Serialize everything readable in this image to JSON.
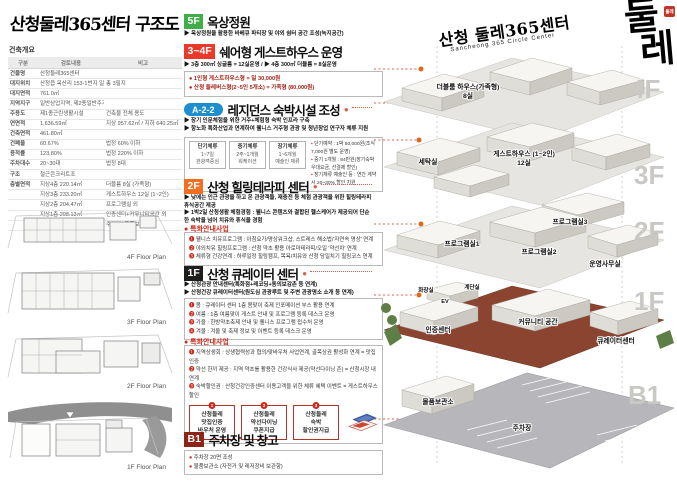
{
  "colors": {
    "c-5f": "#3fae49",
    "c-34f": "#e8392b",
    "c-a22": "#1e8fce",
    "c-2f": "#f26f21",
    "c-1f": "#1d1d1b",
    "c-b1": "#8e2418",
    "c-red": "#cc2a1c",
    "c-dash": "#d9604a",
    "c-floorlabel": "#cac8c4",
    "c-slab-brown": "#8a4430",
    "c-parking": "#b7b7bb",
    "c-green": "#5d7f45"
  },
  "left": {
    "title": "산청둘레365센터 구조도",
    "overview_label": "건축개요",
    "table": {
      "headers": [
        "구분",
        "검토내용",
        "비고"
      ],
      "rows": [
        [
          "건물명",
          "산청둘레365센터",
          ""
        ],
        [
          "대지위치",
          "산청읍 옥산리 153-1번지 일원",
          "총 3필지"
        ],
        [
          "대지면적",
          "761.0㎡",
          ""
        ],
        [
          "지역지구",
          "일반상업지역, 제2종일반주거지역",
          ""
        ],
        [
          "주용도",
          "제1종근린생활시설",
          "건축물 전체 용도"
        ],
        [
          "연면적",
          "1,636.59㎡",
          "지상 957.62㎡ / 지하 640.25㎡"
        ],
        [
          "건축면적",
          "461.80㎡",
          ""
        ],
        [
          "건폐율",
          "60.67%",
          "법정 60% 이하"
        ],
        [
          "용적률",
          "123.80%",
          "법정 220% 이하"
        ],
        [
          "주차대수",
          "20~30대",
          "법정 8대"
        ],
        [
          "구조",
          "철근콘크리트조",
          ""
        ],
        [
          "층별면적",
          "지상4층  220.14㎡",
          "더블룸 8실 (가족형)"
        ],
        [
          "",
          "지상3층  233.20㎡",
          "게스트하우스 12실 (1~2인)"
        ],
        [
          "",
          "지상2층  204.47㎡",
          "프로그램실 외"
        ],
        [
          "",
          "지상1층  208.13㎡",
          "인증센터+커뮤니티공간 외"
        ],
        [
          "",
          "지하1층  640.55㎡",
          "주차장+물품보관소"
        ]
      ]
    },
    "floor_plans": [
      "4F Floor Plan",
      "3F Floor Plan",
      "2F Floor Plan",
      "1F Floor Plan"
    ]
  },
  "sections": {
    "s5f": {
      "badge": "5F",
      "title": "옥상정원",
      "bullets": [
        "▶ 옥상정원을 활용한 바베큐 파티장 및 야외 쉼터 공간 조성(녹지공간)"
      ]
    },
    "s34f": {
      "badge": "3~4F",
      "title": "쉐어형 게스트하우스 운영",
      "bullets": [
        "▶ 3층 300㎡ 싱글룸 = 12실운영 / ▶ 4층 300㎡ 더블룸 = 8실운영"
      ],
      "notes": [
        "● 1인형 게스트하우스형 = 일 30,000원",
        "● 산청 둘레버스형(2~5인 5개소) = 가족형 (80,000원)"
      ]
    },
    "sa22": {
      "badge": "A-2-2",
      "title": "레지던스 숙박시설 조성",
      "bullets": [
        "▶ 장기 인문체험을 위한 거주+체험형 숙박 인프라 구축",
        "▶ 항노화 특화산업과 연계하여 웰니스 거주형 관광 및 청년창업 연구자 체류 지원"
      ],
      "cells": [
        {
          "t": "단기체류",
          "m": "1~7일",
          "b": "관광객중심"
        },
        {
          "t": "중기체류",
          "m": "2주~1개월",
          "b": "워케이션"
        },
        {
          "t": "장기체류",
          "m": "1~6개월",
          "b": "예술인 체류"
        }
      ],
      "notes": [
        "▪ 단기예약 : 1박 50,000원(조식 7,000원 별도 운영)",
        "▪ 중기 1개월 : 84만원(장기숙박 우대요금, 선결제 할인)",
        "▪ 장기체류 예술인 등 : 연간 계약시 20~30% 할인 지원"
      ]
    },
    "s2f": {
      "badge": "2F",
      "title": "산청 힐링테라피 센터",
      "bullets": [
        "▶ 낮에는 인근 관광을 하고 온 관광객들, 재충전 등 체험 관광객을 위한 힐링테라피 휴식공간 제공",
        "▶ 1박2일 산청생활 체험경험 : 웰니스 콘텐츠와 결합된 헬스케어가 제공되어 단순한 숙박을 넘어 치유와 휴식을 경험"
      ],
      "special_label": "● 특화안내사업",
      "notes": [
        "❶ 웰니스 치유프로그램 : 아침요가/명상워크샵, 스트레스 해소법/'자연속 명상' 연계",
        "❷ 야외치유 힐링프로그램 : 산청 약초 활용 아로마테라피/오일 '약선차' 연계",
        "❸ 체류형 건강연계 : 하루일정 힐링캠프, 목욕/치유와 산청 당일치기 힐링코스 연계"
      ]
    },
    "s1f": {
      "badge": "1F",
      "title": "산청 큐레이터 센터",
      "bullets": [
        "▶ 산청관광 안내센터(특화점+레코딩+동의보감촌 등 연계)",
        "▶ 산청건강 큐레이터센터(원도심 관광루트 및 주변 관광명소 소개 등 연계)"
      ],
      "season_notes": [
        "❶ 봄 : 큐레이터 센터 1층 봄맞이 축제 인포메이션 부스 활용 연계",
        "❷ 여름 : 1층 여름맞이 게스트 안내 및 프로그램 등록 데스크 운영",
        "❸ 가을 : 한방약초축제 안내 및 웰니스 프로그램 접수처 운영",
        "❹ 겨울 : 겨울 및 축제 정보 및 이벤트 등록 데스크 운영"
      ],
      "special_label": "● 특화안내사업",
      "special_notes": [
        "❶ 지역상생회 : 상생협력성과 협의/맞바우처 사업연계, 골목상권 활성화 연계 = 맛집 인증",
        "❷ 약선 한끼 제공 : 지역 약초를 활용한 건강식사 제공(약선다이닝 존) = 산청시장 내 연계",
        "❸ 숙박할인권 : 산청건강인증센터 이용고객을 위한 체류 혜택 이벤트 = 게스트하우스 할인"
      ],
      "vouchers": [
        {
          "no": "1",
          "l1": "산청둘레",
          "l2": "맛집인증",
          "l3": "바우처 운영"
        },
        {
          "no": "2",
          "l1": "산청둘레",
          "l2": "약선다이닝",
          "l3": "쿠폰지급"
        },
        {
          "no": "3",
          "l1": "산청둘레",
          "l2": "숙박",
          "l3": "할인권지급"
        }
      ]
    },
    "sb1": {
      "badge": "B1",
      "title": "주차장 및 창고",
      "notes": [
        "● 주차장 20면 조성",
        "● 물품보관소 (자전거 및 레저장비 보관함)"
      ]
    }
  },
  "brand": {
    "kr": "산청 둘레365센터",
    "en": "Sancheong 365 Circle Center",
    "logo_top": "둘",
    "logo_bottom": "레",
    "seal": "둘레"
  },
  "building": {
    "floors": [
      {
        "label": "4F",
        "rooms": [
          "더블룸 하우스(가족형)",
          "8실"
        ]
      },
      {
        "label": "3F",
        "rooms": [
          "세탁실",
          "게스트하우스 (1~2인)",
          "12실"
        ]
      },
      {
        "label": "2F",
        "rooms": [
          "프로그램실1",
          "프로그램실2",
          "프로그램실3",
          "운영사무실"
        ]
      },
      {
        "label": "1F",
        "rooms": [
          "화장실",
          "계단실",
          "EV",
          "인증센터",
          "커뮤니티 공간",
          "큐레이터센터"
        ]
      },
      {
        "label": "B1",
        "rooms": [
          "물품보관소",
          "주차장"
        ]
      }
    ]
  }
}
